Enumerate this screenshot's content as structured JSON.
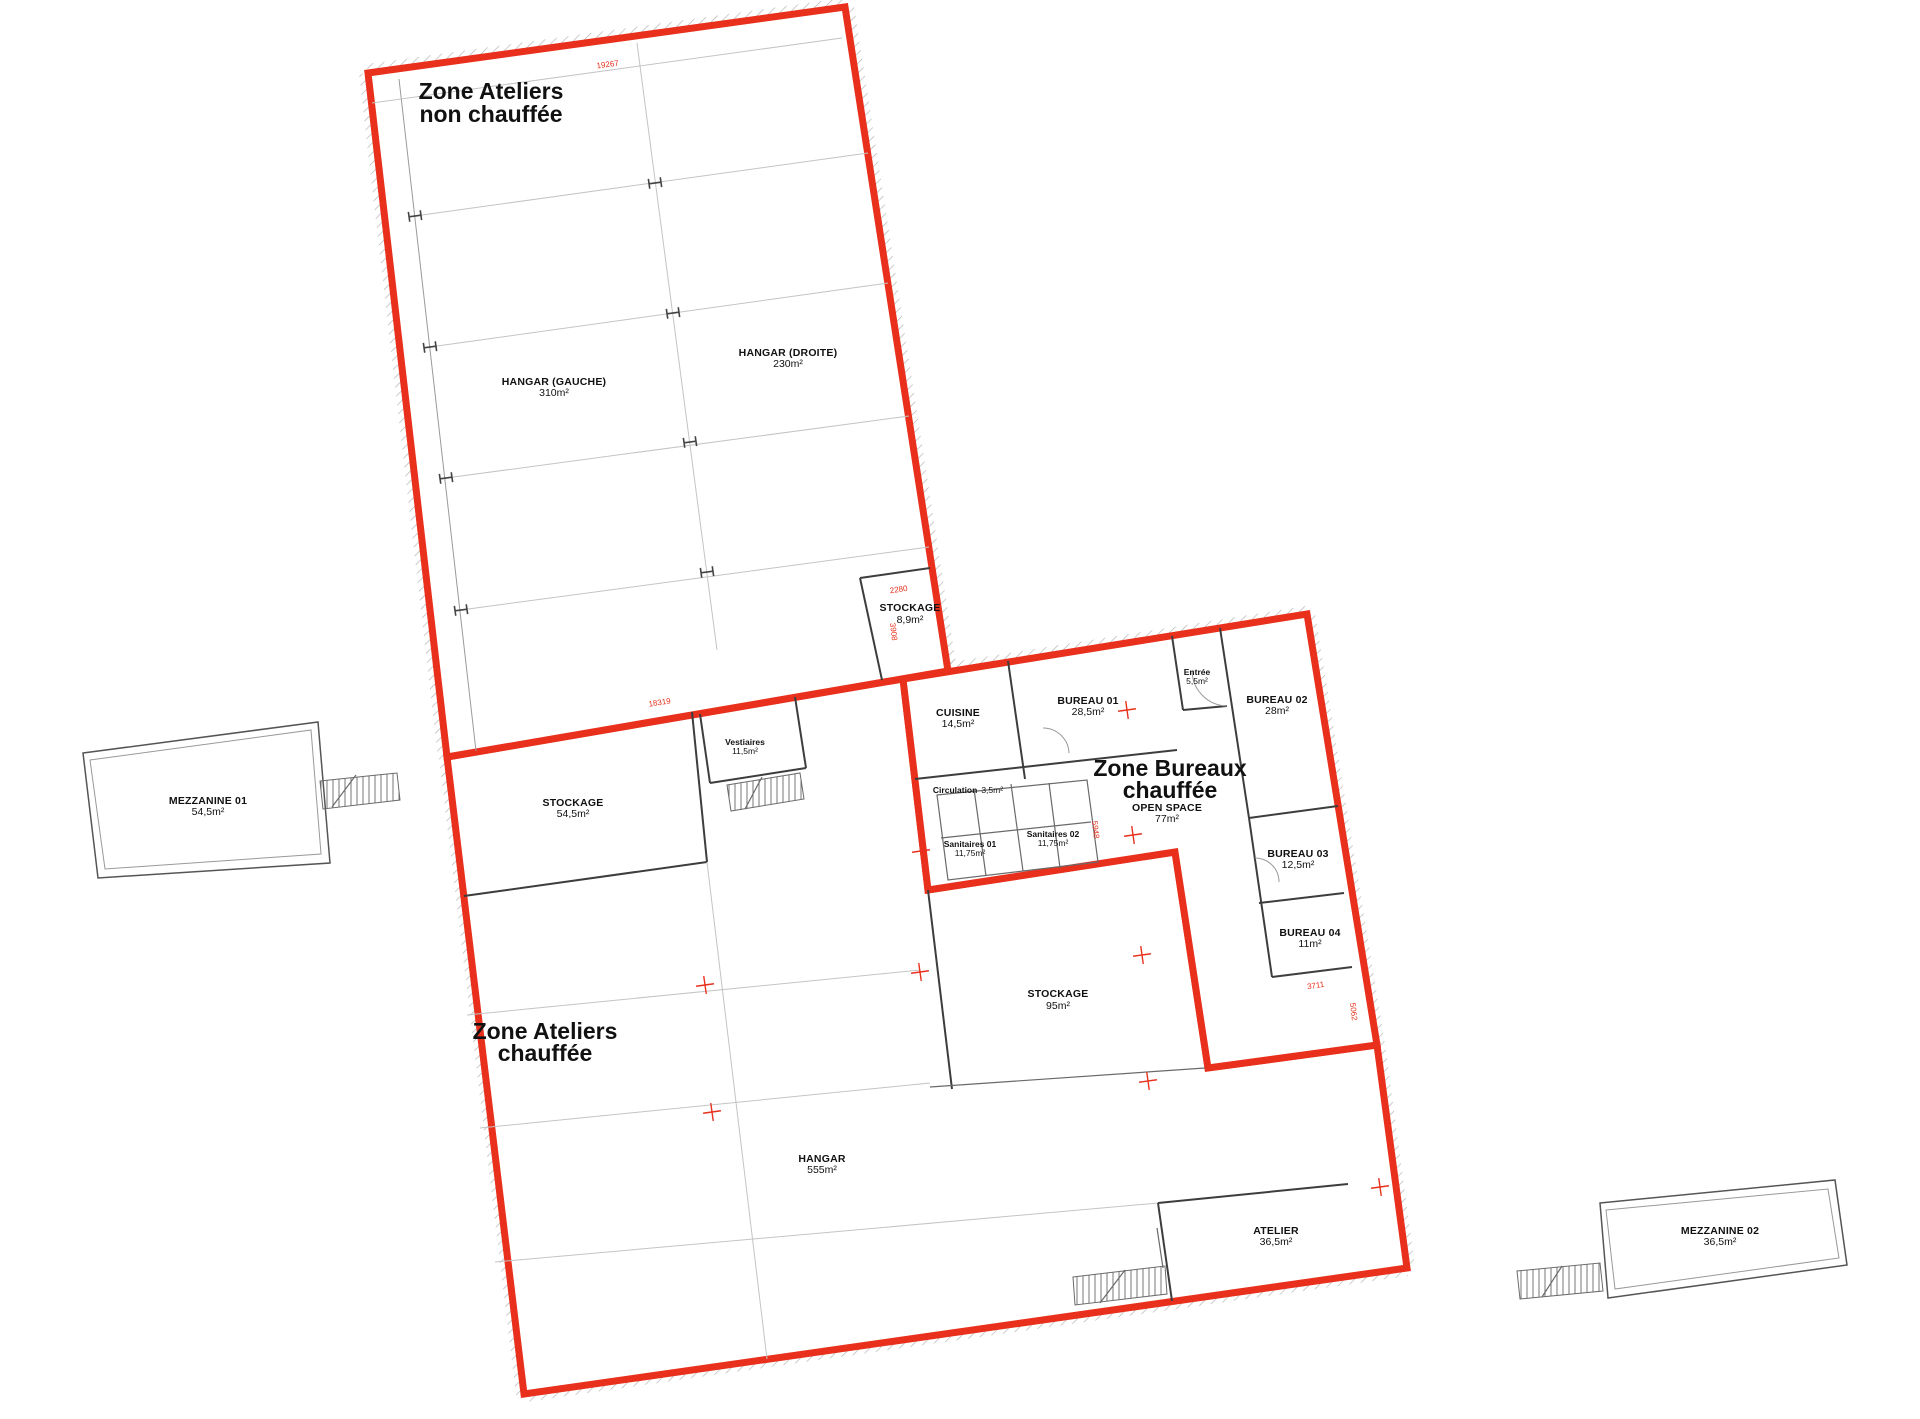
{
  "zones": {
    "non_chauffee": {
      "line1": "Zone Ateliers",
      "line2": "non chauffée"
    },
    "bureaux": {
      "line1": "Zone Bureaux",
      "line2": "chauffée"
    },
    "chauffee": {
      "line1": "Zone Ateliers",
      "line2": "chauffée"
    }
  },
  "rooms": {
    "hangar_gauche": {
      "name": "HANGAR (GAUCHE)",
      "area": "310m²"
    },
    "hangar_droite": {
      "name": "HANGAR (DROITE)",
      "area": "230m²"
    },
    "stockage_89": {
      "name": "STOCKAGE",
      "area": "8,9m²"
    },
    "cuisine": {
      "name": "CUISINE",
      "area": "14,5m²"
    },
    "bureau_01": {
      "name": "BUREAU 01",
      "area": "28,5m²"
    },
    "entree": {
      "name": "Entrée",
      "area": "5,5m²"
    },
    "bureau_02": {
      "name": "BUREAU 02",
      "area": "28m²"
    },
    "bureau_03": {
      "name": "BUREAU 03",
      "area": "12,5m²"
    },
    "bureau_04": {
      "name": "BUREAU 04",
      "area": "11m²"
    },
    "open_space": {
      "name": "OPEN SPACE",
      "area": "77m²"
    },
    "circulation": {
      "name": "Circulation",
      "area": "3,5m²"
    },
    "sanitaires_01": {
      "name": "Sanitaires 01",
      "area": "11,75m²"
    },
    "sanitaires_02": {
      "name": "Sanitaires 02",
      "area": "11,75m²"
    },
    "stockage_54": {
      "name": "STOCKAGE",
      "area": "54,5m²"
    },
    "vestiaires": {
      "name": "Vestiaires",
      "area": "11,5m²"
    },
    "stockage_95": {
      "name": "STOCKAGE",
      "area": "95m²"
    },
    "hangar": {
      "name": "HANGAR",
      "area": "555m²"
    },
    "atelier": {
      "name": "ATELIER",
      "area": "36,5m²"
    },
    "mezzanine_01": {
      "name": "MEZZANINE 01",
      "area": "54,5m²"
    },
    "mezzanine_02": {
      "name": "MEZZANINE 02",
      "area": "36,5m²"
    }
  },
  "dimensions": {
    "top_edge": "19267",
    "diagonal_edge": "18319",
    "stockage_width": "2280",
    "stockage_height": "3908",
    "bureau04_width": "3711",
    "right_edge": "5062",
    "sanitaires_height": "5948"
  },
  "colors": {
    "zone_outline": "#e8301c",
    "dimension_text": "#e8301c"
  }
}
